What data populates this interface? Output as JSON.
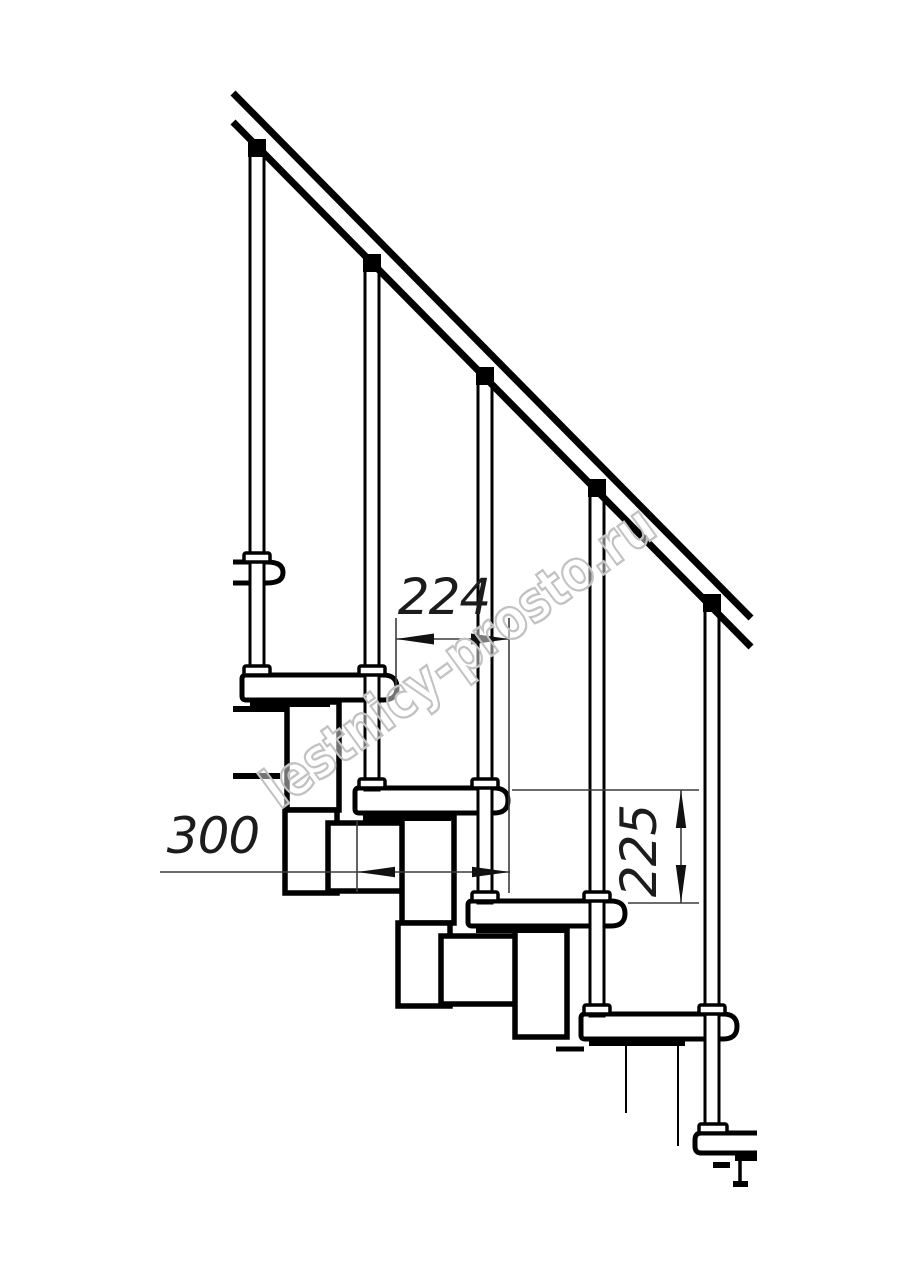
{
  "drawing": {
    "subject": "Modular staircase side-view technical drawing with handrail, balusters, treads and step modules",
    "dim_run": "224",
    "dim_depth": "300",
    "dim_rise": "225",
    "watermark": "lestnicy-prosto.ru",
    "colors": {
      "line": "#000000",
      "dimension": "#3c3c3c",
      "watermark_outline": "#c2c2c2",
      "background": "#ffffff"
    }
  }
}
